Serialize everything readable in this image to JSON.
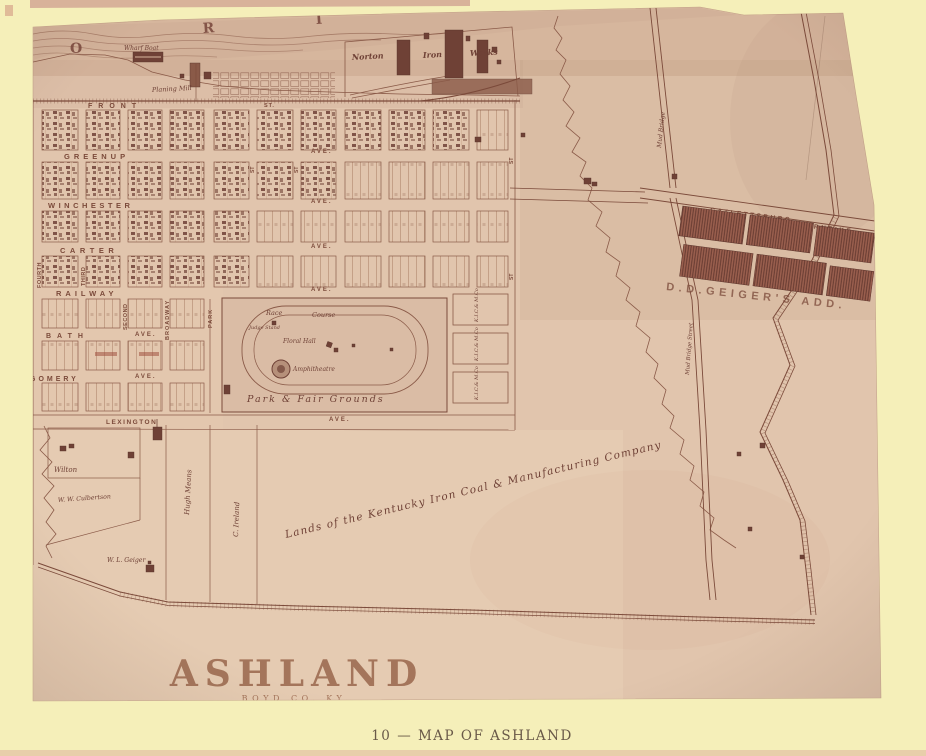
{
  "caption": "10 — MAP OF ASHLAND",
  "title": {
    "city": "ASHLAND",
    "county": "BOYD CO. KY.",
    "scale": "Scale 500 Feet to 1 Inch"
  },
  "river": {
    "letter_o": "O",
    "letter_r": "R",
    "letter_i": "I",
    "wharf_boat": "Wharf Boat",
    "planing_mill": "Planing Mill"
  },
  "iron_works": {
    "word1": "Norton",
    "word2": "Iron",
    "word3": "Works"
  },
  "streets": {
    "front": "FRONT",
    "front_st": "ST.",
    "greenup": "GREENUP",
    "winchester": "WINCHESTER",
    "carter": "CARTER",
    "railway": "RAILWAY",
    "bath": "BATH",
    "gomery": "GOMERY",
    "lexington": "LEXINGTON",
    "ave": "AVE.",
    "st": "ST",
    "fourth": "FOURTH",
    "third": "THIRD",
    "second": "SECOND",
    "broadway": "BROADWAY",
    "park": "PARK"
  },
  "fairgrounds": {
    "race": "Race",
    "course": "Course",
    "judge_stand": "Judge Stand",
    "floral_hall": "Floral Hall",
    "amphitheatre": "Amphitheatre",
    "name": "Park & Fair Grounds"
  },
  "company_blocks": {
    "label": "K.I.C.& M.Co"
  },
  "roads": {
    "catlettsburg": "CATLETTSBURG",
    "turnpike": "TURNPIKE",
    "geigers_add": "D.D.GEIGER'S ADD.",
    "mud_bridge": "Mud Bridge",
    "mud_bridge_street": "Mud Bridge Street"
  },
  "properties": {
    "wilton": "Wilton",
    "culbertson": "W. W. Culbertson",
    "means": "Hugh Means",
    "ireland": "C. Ireland",
    "geiger": "W. L. Geiger",
    "lands": "Lands of the Kentucky Iron Coal & Manufacturing Company"
  },
  "colors": {
    "page_background": "#f5efb9",
    "sheet": "#e1c5ad",
    "ink": "#7b4a3a",
    "dark_blocks": "#91584a",
    "title_brown": "#a4755b",
    "caption_text": "#695948"
  }
}
